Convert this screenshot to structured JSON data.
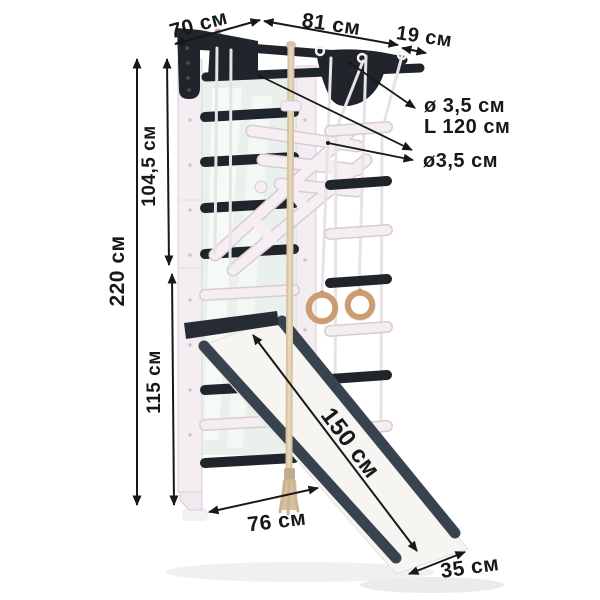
{
  "labels": {
    "depth_top": "70 см",
    "bar_length": "81 см",
    "bar_overhang": "19 см",
    "pullup_bar_diameter": "ø 3,5 см",
    "pullup_bar_length": "L 120 см",
    "rung_diameter": "ø3,5 см",
    "total_height": "220 см",
    "upper_section_height": "104,5 см",
    "lower_section_height": "115 см",
    "base_depth": "76 см",
    "slide_length": "150 см",
    "slide_width": "35 см"
  },
  "colors": {
    "ink": "#17181a",
    "frame_dark": "#20242b",
    "frame_white": "#f4eef3",
    "slide_rail": "#39434f",
    "rope_beige": "#d8c3a3",
    "ring_wood": "#cc9c70",
    "mirror_green": "#eaf1ec"
  }
}
